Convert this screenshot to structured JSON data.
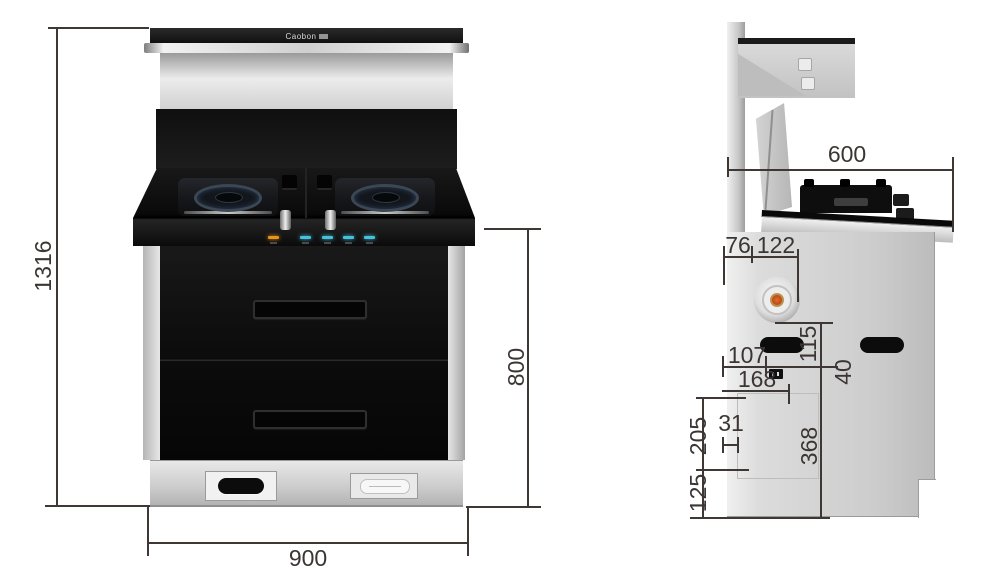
{
  "brand": {
    "logo_text": "Caobon"
  },
  "front_view": {
    "dim_total_height": "1316",
    "dim_cabinet_height": "800",
    "dim_width": "900"
  },
  "side_view": {
    "dim_depth": "600",
    "dim_flue_back_offset": "76",
    "dim_flue_span": "122",
    "dim_flue_drop": "115",
    "dim_inlet_back_offset": "107",
    "dim_inlet_drop": "40",
    "dim_socket_back_offset": "168",
    "dim_panel_top_offset": "205",
    "dim_hook_width": "31",
    "dim_panel_height": "368",
    "dim_bottom_clearance": "125"
  },
  "colors": {
    "indicator_power": "#e8941a",
    "indicator_active": "#45c0dd",
    "flue_center": "#c75a20",
    "dim_line": "#3e3734"
  }
}
